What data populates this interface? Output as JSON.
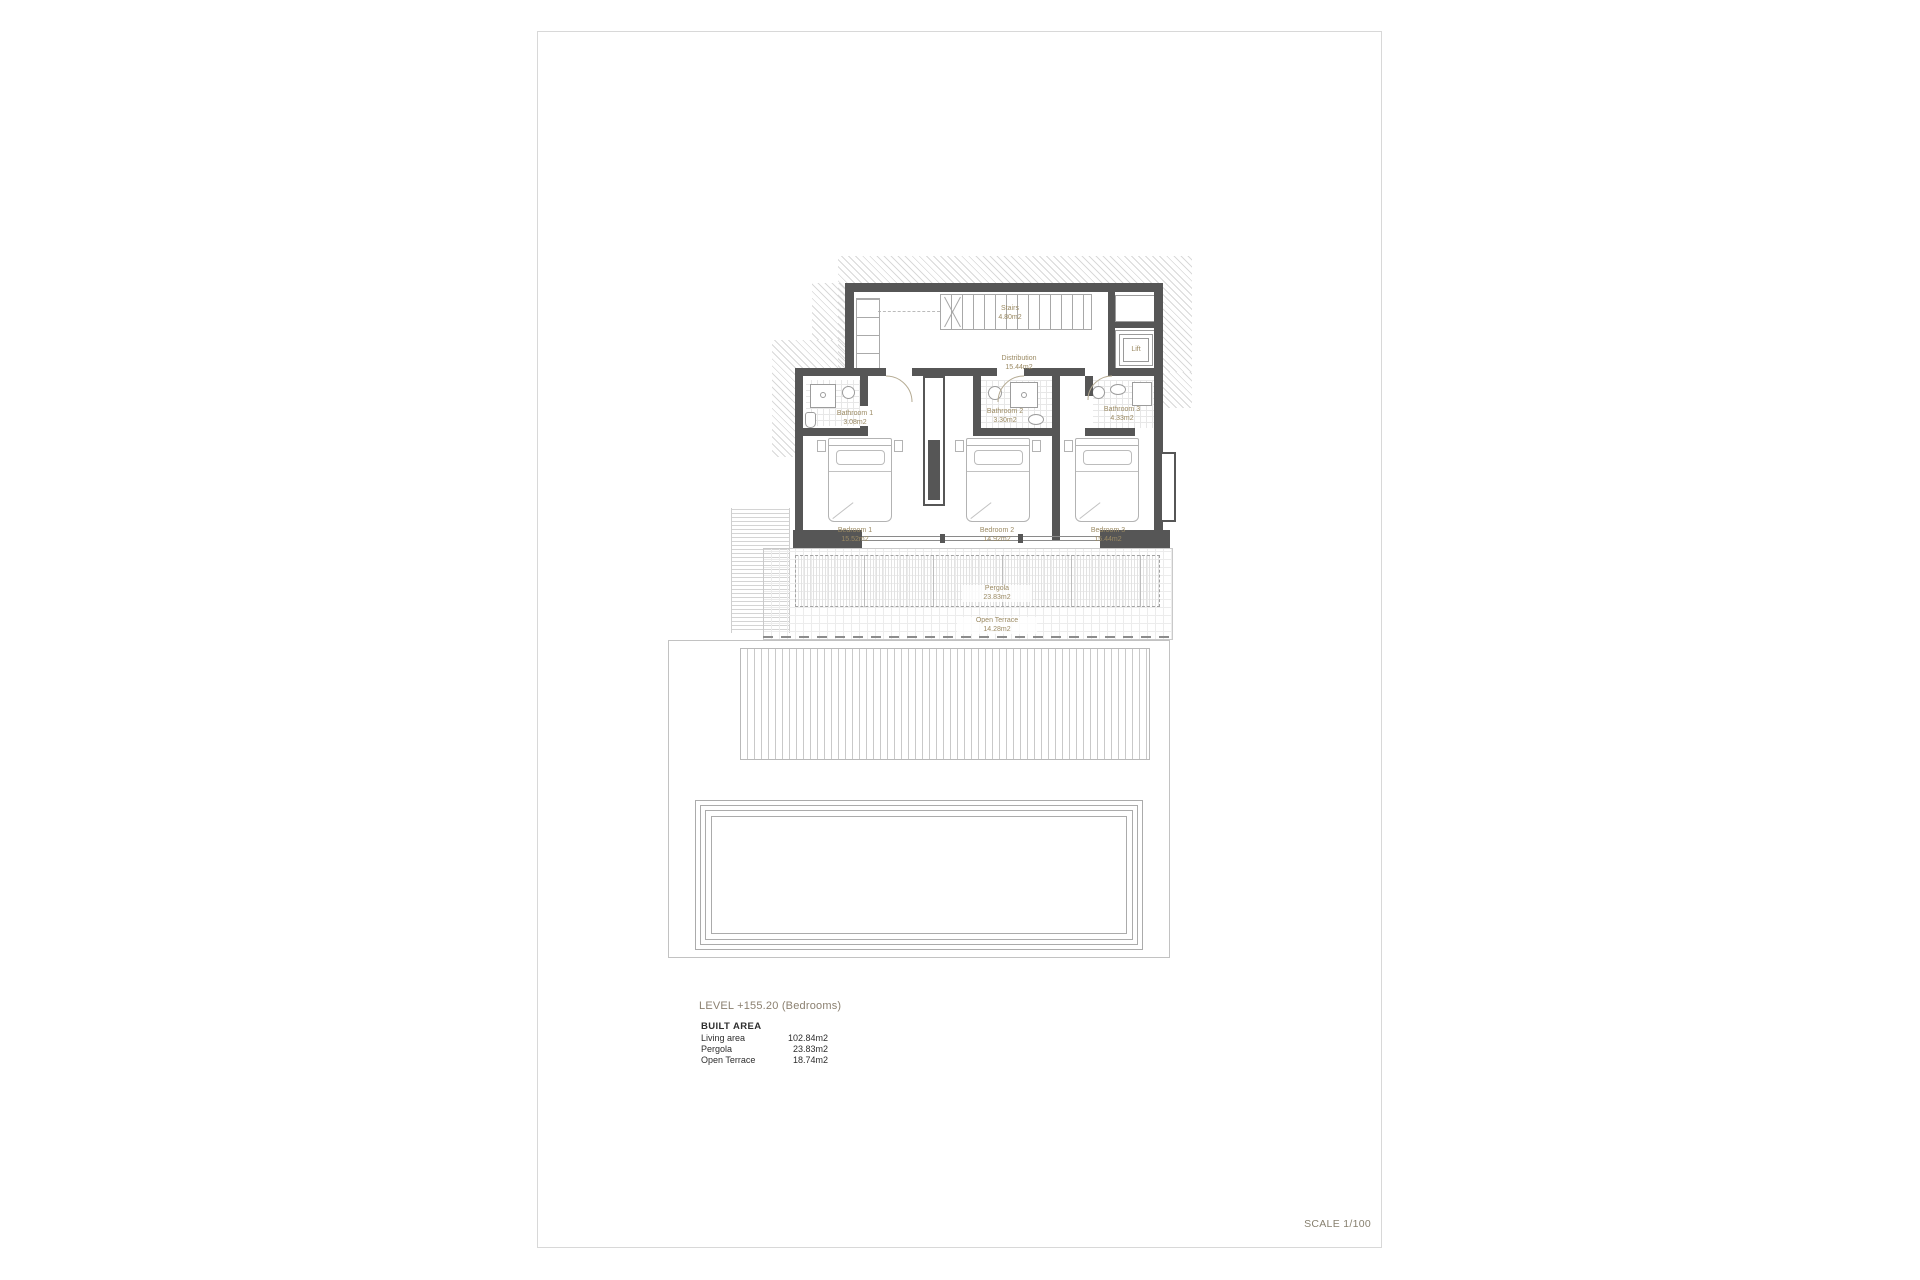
{
  "sheet": {
    "scale_label": "SCALE 1/100"
  },
  "title_block": {
    "level_title": "LEVEL +155.20 (Bedrooms)",
    "built_area_heading": "BUILT AREA",
    "areas": [
      {
        "label": "Living area",
        "value": "102.84m2"
      },
      {
        "label": "Pergola",
        "value": "23.83m2"
      },
      {
        "label": "Open Terrace",
        "value": "18.74m2"
      }
    ]
  },
  "rooms": [
    {
      "name": "Stairs",
      "area": "4.80m2"
    },
    {
      "name": "Distribution",
      "area": "15.44m2"
    },
    {
      "name": "Lift",
      "area": ""
    },
    {
      "name": "Bathroom 1",
      "area": "3.08m2"
    },
    {
      "name": "Bathroom 2",
      "area": "3.30m2"
    },
    {
      "name": "Bathroom 3",
      "area": "4.33m2"
    },
    {
      "name": "Bedroom 1",
      "area": "15.52m2"
    },
    {
      "name": "Bedroom 2",
      "area": "14.92m2"
    },
    {
      "name": "Bedroom 3",
      "area": "15.44m2"
    },
    {
      "name": "Pergola",
      "area": "23.83m2"
    },
    {
      "name": "Open Terrace",
      "area": "14.28m2"
    }
  ],
  "colors": {
    "wall": "#565656",
    "room_label": "#9b8a63",
    "title": "#8b8070",
    "sheet_border": "#d8d8d8",
    "hatch": "#d9d9d9"
  }
}
